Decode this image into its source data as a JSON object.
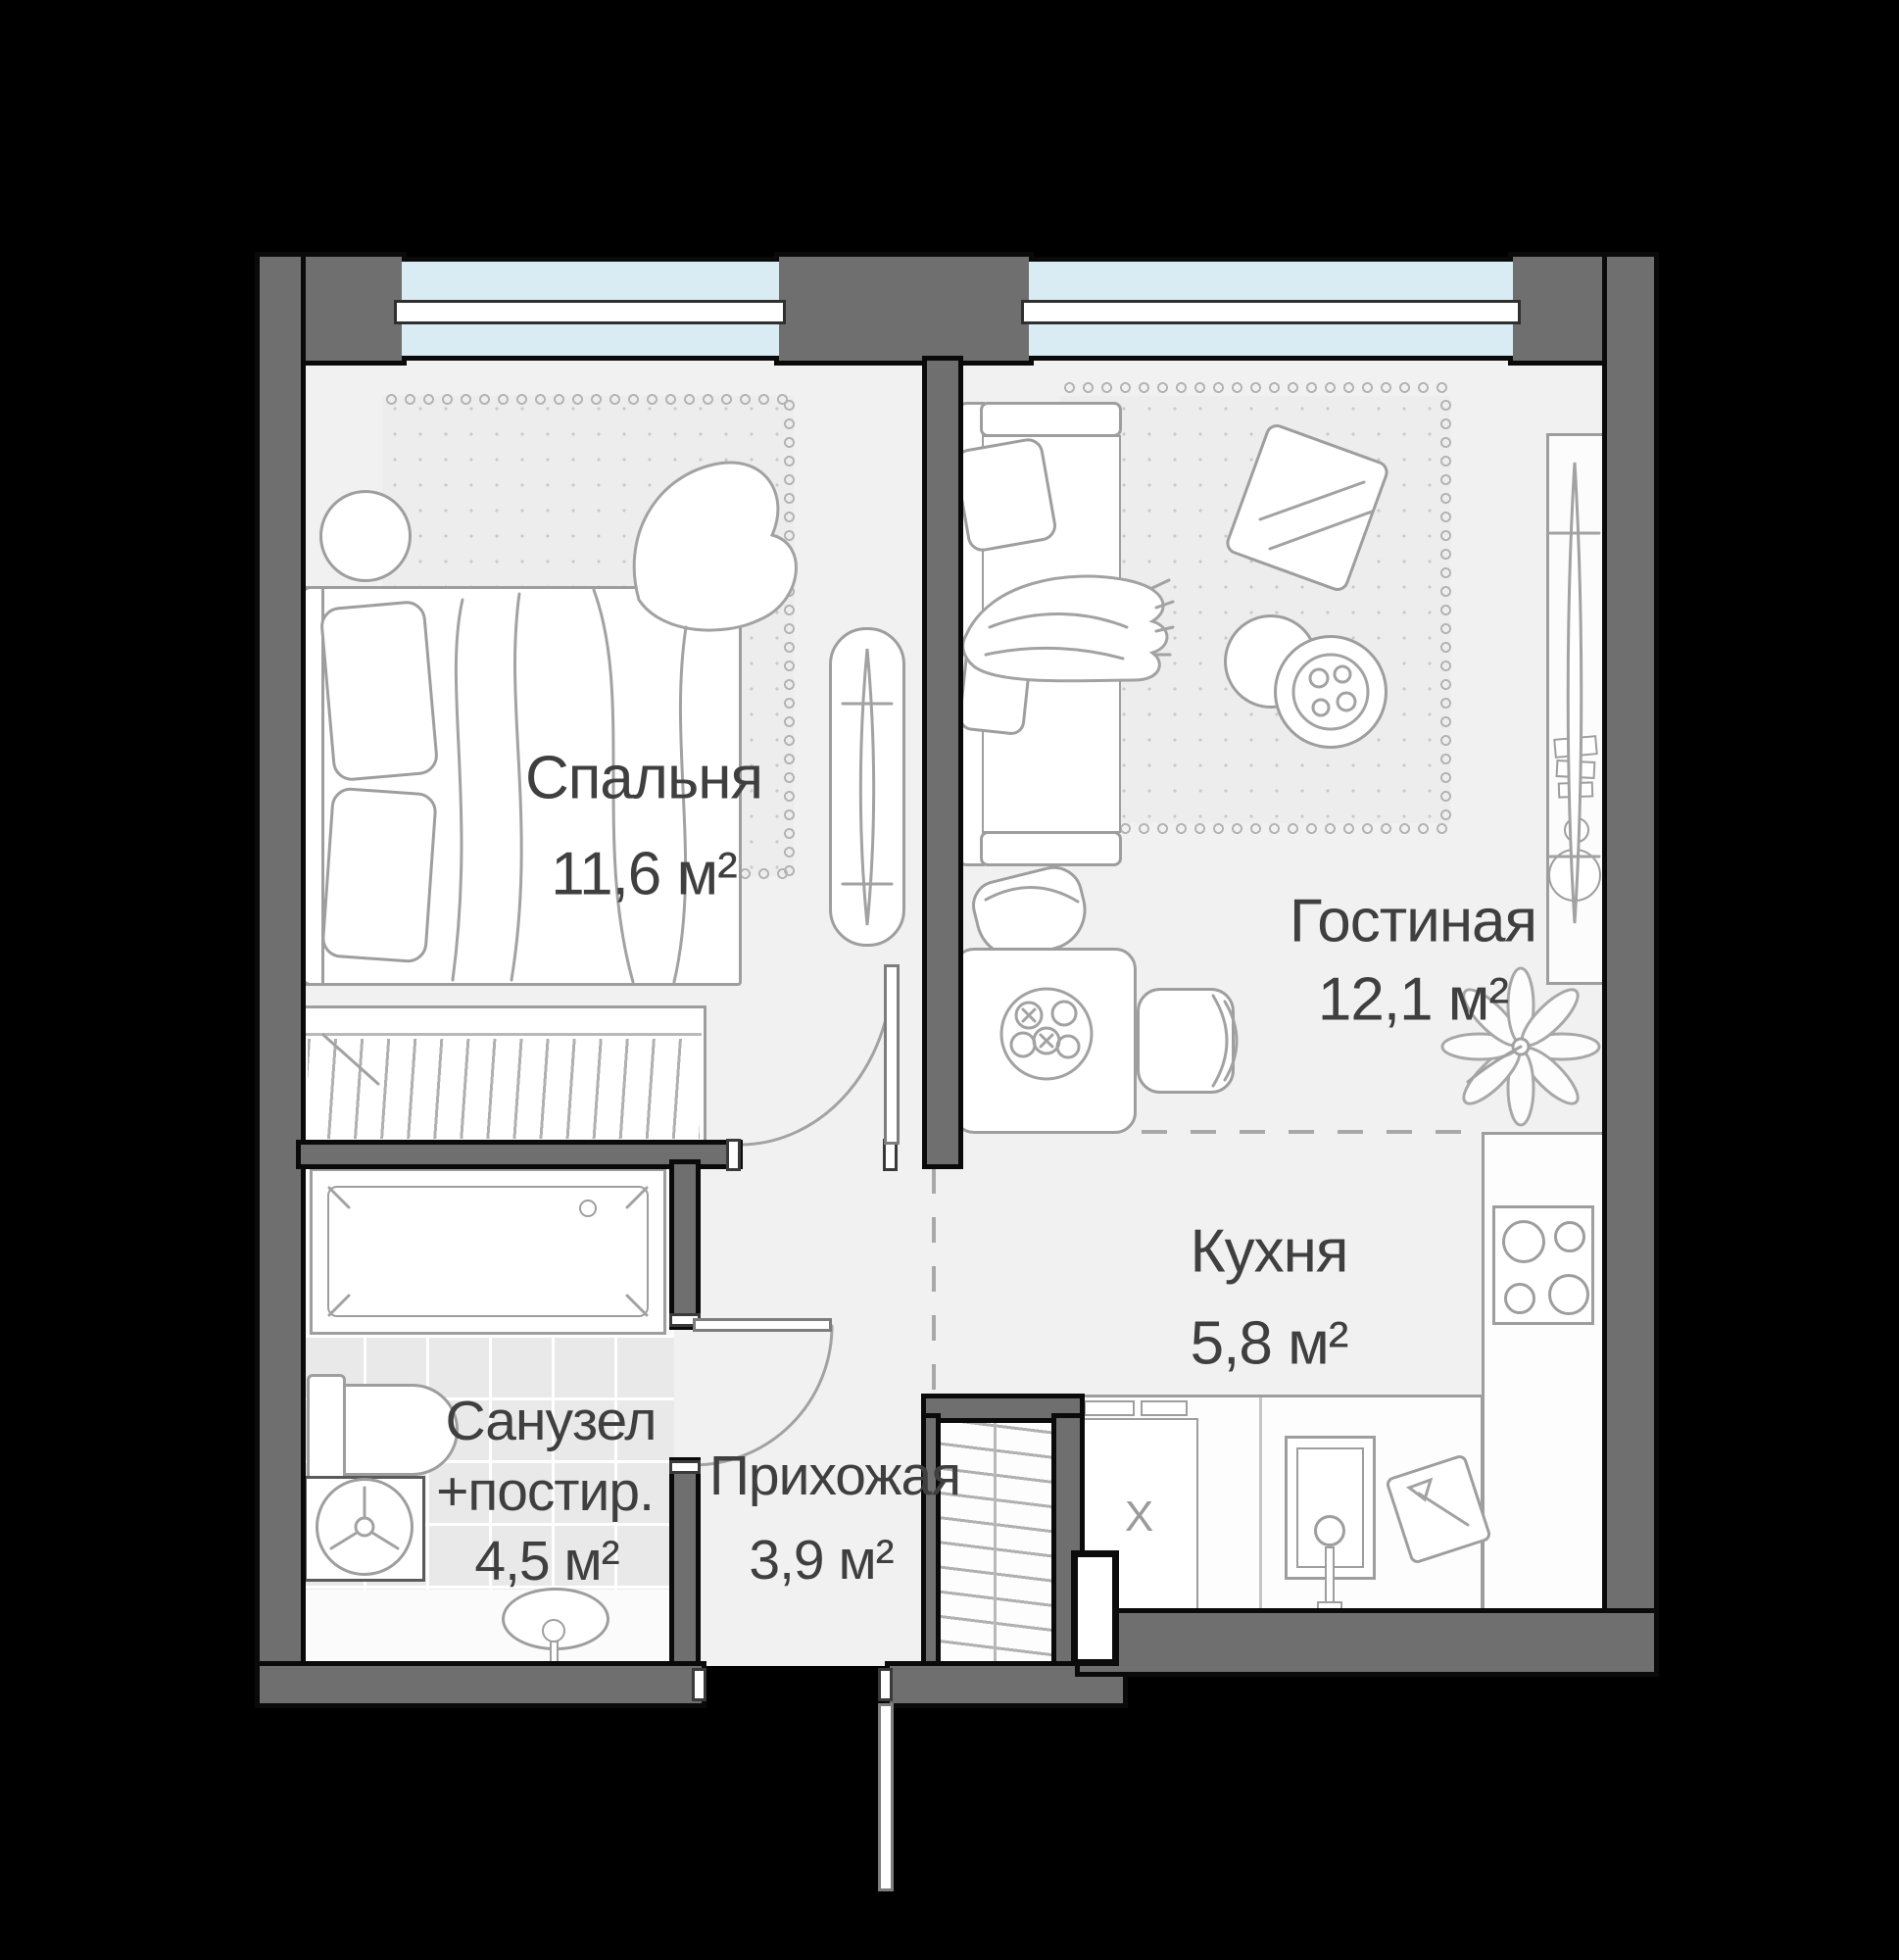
{
  "plan": {
    "type": "apartment-floor-plan",
    "background_color": "#000000",
    "wall_color": "#6f6f6f",
    "floor_color": "#f1f1f2",
    "window_glass_color": "#d9ecf4",
    "label_color": "#3f3f3f",
    "rooms": [
      {
        "name": "Спальня",
        "area": "11,6 м²"
      },
      {
        "name": "Гостиная",
        "area": "12,1 м²"
      },
      {
        "name": "Кухня",
        "area": "5,8 м²"
      },
      {
        "name": "Санузел",
        "name_line2": "+постир.",
        "area": "4,5 м²"
      },
      {
        "name": "Прихожая",
        "area": "3,9 м²"
      }
    ],
    "markers": {
      "dishwasher": "X"
    }
  }
}
